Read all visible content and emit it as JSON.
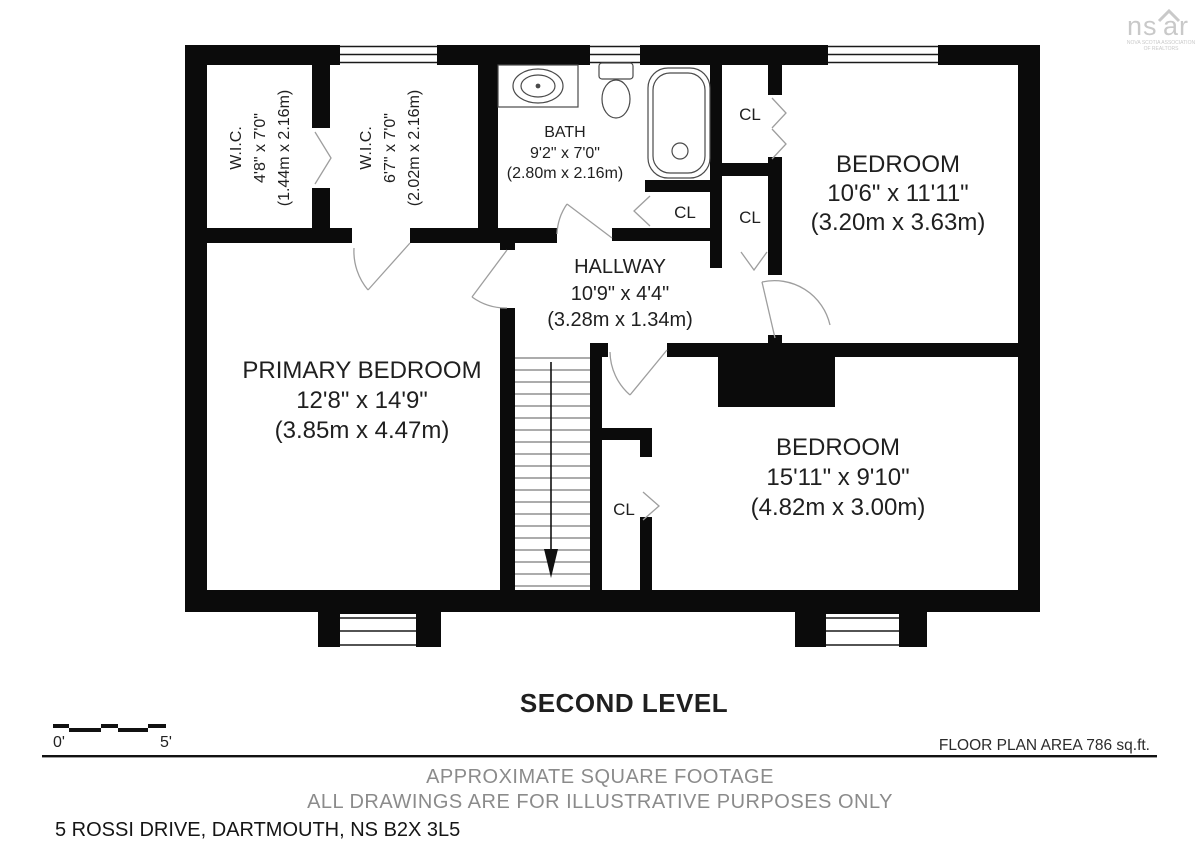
{
  "logo": {
    "left": "ns",
    "right": "ar",
    "sub1": "NOVA SCOTIA ASSOCIATION",
    "sub2": "OF REALTORS"
  },
  "labels": {
    "closet": "CL"
  },
  "rooms": {
    "wic1": {
      "name": "W.I.C.",
      "imperial": "4'8\" x 7'0\"",
      "metric": "(1.44m x 2.16m)"
    },
    "wic2": {
      "name": "W.I.C.",
      "imperial": "6'7\" x 7'0\"",
      "metric": "(2.02m x 2.16m)"
    },
    "bath": {
      "name": "BATH",
      "imperial": "9'2\" x 7'0\"",
      "metric": "(2.80m x 2.16m)"
    },
    "bedroom_top": {
      "name": "BEDROOM",
      "imperial": "10'6\" x 11'11\"",
      "metric": "(3.20m x 3.63m)"
    },
    "hallway": {
      "name": "HALLWAY",
      "imperial": "10'9\" x 4'4\"",
      "metric": "(3.28m x 1.34m)"
    },
    "primary": {
      "name": "PRIMARY BEDROOM",
      "imperial": "12'8\" x 14'9\"",
      "metric": "(3.85m x 4.47m)"
    },
    "bedroom_bottom": {
      "name": "BEDROOM",
      "imperial": "15'11\" x 9'10\"",
      "metric": "(4.82m x 3.00m)"
    }
  },
  "footer": {
    "level_title": "SECOND LEVEL",
    "scale_start": "0'",
    "scale_end": "5'",
    "area": "FLOOR PLAN AREA 786 sq.ft.",
    "disclaimer1": "APPROXIMATE SQUARE FOOTAGE",
    "disclaimer2": "ALL DRAWINGS ARE FOR ILLUSTRATIVE PURPOSES ONLY",
    "address": "5 ROSSI DRIVE, DARTMOUTH, NS B2X 3L5"
  },
  "colors": {
    "wall": "#0b0b0b",
    "gray_text": "#8b8b8b",
    "door_line": "#9e9e9e",
    "logo": "#c9c9c9"
  }
}
